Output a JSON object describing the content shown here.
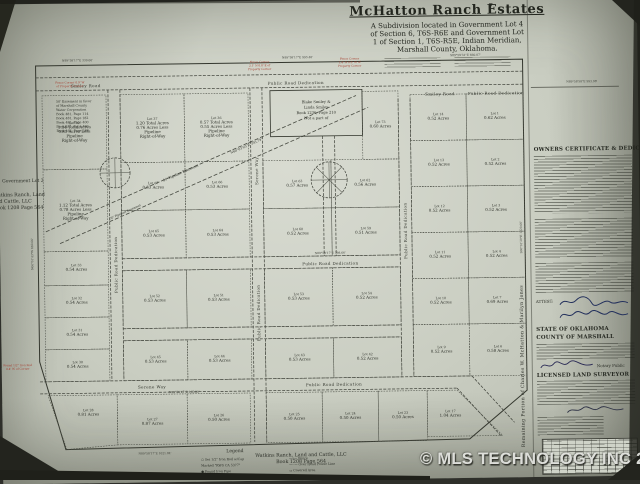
{
  "watermark": "© MLS TECHNOLOGY INC 2026",
  "title_block": {
    "title": "McHatton Ranch Estates",
    "subtitle_lines": [
      "A Subdivision located in Government Lot 4",
      "of Section 6, T6S-R6E and Government Lot",
      "1 of Section 1, T6S-R5E, Indian Meridian,",
      "Marshall County, Oklahoma."
    ]
  },
  "right_panel": {
    "vertical_note": "Remaining Portion of Charles W. McHatton & Marilyn Jones",
    "owners_heading": "OWNERS CERTIFICATE & DEDICATION",
    "attest": "ATTEST:",
    "state": "STATE OF OKLAHOMA",
    "county": "COUNTY OF MARSHALL",
    "notary": "Notary Public",
    "surveyor_heading": "LICENSED LAND SURVEYOR"
  },
  "map": {
    "exception": {
      "x": 272,
      "y": 90,
      "w": 92,
      "h": 46,
      "lines": [
        "Blake Smiley &",
        "Linda Smiley",
        "Book 1236, Page 210",
        "Not a part of"
      ]
    },
    "lots": [
      {
        "x": 44,
        "y": 92,
        "w": 64,
        "h": 74,
        "lines": [
          "Lot 35",
          "1.14 Total Acres",
          "0.81 Acres Less",
          "Pipeline",
          "Right-of-Way"
        ]
      },
      {
        "x": 44,
        "y": 166,
        "w": 64,
        "h": 82,
        "lines": [
          "Lot 34",
          "1.12 Total Acres",
          "0.78 Acres Less",
          "Pipeline",
          "Right-of-Way"
        ]
      },
      {
        "x": 44,
        "y": 248,
        "w": 64,
        "h": 34,
        "lines": [
          "Lot 33",
          "0.54 Acres"
        ]
      },
      {
        "x": 44,
        "y": 282,
        "w": 64,
        "h": 32,
        "lines": [
          "Lot 32",
          "0.54 Acres"
        ]
      },
      {
        "x": 44,
        "y": 314,
        "w": 64,
        "h": 32,
        "lines": [
          "Lot 31",
          "0.54 Acres"
        ]
      },
      {
        "x": 44,
        "y": 346,
        "w": 64,
        "h": 32,
        "lines": [
          "Lot 30",
          "0.54 Acres"
        ]
      },
      {
        "pts": "46,392 115,392 115,442 64,446",
        "cx": 86,
        "cy": 408,
        "lines": [
          "Lot 28",
          "0.81 Acres"
        ]
      },
      {
        "pts": "115,392 185,392 185,442 115,442",
        "cx": 150,
        "cy": 418,
        "lines": [
          "Lot 27",
          "0.87 Acres"
        ]
      },
      {
        "x": 122,
        "y": 92,
        "w": 64,
        "h": 68,
        "lines": [
          "Lot 37",
          "1.20 Total Acres",
          "0.76 Acres Less",
          "Pipeline",
          "Right-of-Way"
        ]
      },
      {
        "x": 186,
        "y": 92,
        "w": 64,
        "h": 68,
        "lines": [
          "Lot 36",
          "0.57 Total Acres",
          "0.55 Acres Less",
          "Pipeline",
          "Right-of-Way"
        ]
      },
      {
        "x": 122,
        "y": 160,
        "w": 64,
        "h": 48,
        "lines": [
          "Lot 67",
          "0.53 Acres"
        ]
      },
      {
        "x": 186,
        "y": 160,
        "w": 64,
        "h": 48,
        "lines": [
          "Lot 66",
          "0.53 Acres"
        ]
      },
      {
        "x": 122,
        "y": 208,
        "w": 64,
        "h": 48,
        "lines": [
          "Lot 65",
          "0.53 Acres"
        ]
      },
      {
        "x": 186,
        "y": 208,
        "w": 64,
        "h": 48,
        "lines": [
          "Lot 64",
          "0.53 Acres"
        ]
      },
      {
        "x": 122,
        "y": 268,
        "w": 64,
        "h": 58,
        "lines": [
          "Lot 52",
          "0.53 Acres"
        ]
      },
      {
        "x": 186,
        "y": 268,
        "w": 64,
        "h": 58,
        "lines": [
          "Lot 51",
          "0.53 Acres"
        ]
      },
      {
        "x": 122,
        "y": 338,
        "w": 64,
        "h": 40,
        "lines": [
          "Lot 45",
          "0.53 Acres"
        ]
      },
      {
        "x": 186,
        "y": 338,
        "w": 64,
        "h": 40,
        "lines": [
          "Lot 44",
          "0.53 Acres"
        ]
      },
      {
        "x": 185,
        "y": 392,
        "w": 63,
        "h": 50,
        "lines": [
          "Lot 26",
          "0.50 Acres"
        ]
      },
      {
        "x": 264,
        "y": 392,
        "w": 56,
        "h": 50,
        "lines": [
          "Lot 25",
          "0.50 Acres"
        ]
      },
      {
        "x": 320,
        "y": 392,
        "w": 56,
        "h": 50,
        "lines": [
          "Lot 24",
          "0.50 Acres"
        ]
      },
      {
        "x": 376,
        "y": 392,
        "w": 49,
        "h": 50,
        "lines": [
          "Lot 23",
          "0.50 Acres"
        ]
      },
      {
        "pts": "425,392 455,392 500,438 425,438",
        "cx": 448,
        "cy": 414,
        "lines": [
          "Lot 17",
          "1.04 Acres"
        ]
      },
      {
        "x": 364,
        "y": 92,
        "w": 36,
        "h": 68,
        "lines": [
          "Lot 73",
          "0.60 Acres"
        ]
      },
      {
        "x": 264,
        "y": 160,
        "w": 68,
        "h": 48,
        "lines": [
          "Lot 63",
          "0.57 Acres"
        ]
      },
      {
        "x": 332,
        "y": 160,
        "w": 68,
        "h": 48,
        "lines": [
          "Lot 62",
          "0.56 Acres"
        ]
      },
      {
        "x": 264,
        "y": 208,
        "w": 68,
        "h": 48,
        "lines": [
          "Lot 60",
          "0.52 Acres"
        ]
      },
      {
        "x": 332,
        "y": 208,
        "w": 68,
        "h": 48,
        "lines": [
          "Lot 59",
          "0.51 Acres"
        ]
      },
      {
        "x": 264,
        "y": 268,
        "w": 68,
        "h": 58,
        "lines": [
          "Lot 53",
          "0.53 Acres"
        ]
      },
      {
        "x": 332,
        "y": 268,
        "w": 68,
        "h": 58,
        "lines": [
          "Lot 54",
          "0.52 Acres"
        ]
      },
      {
        "x": 264,
        "y": 338,
        "w": 68,
        "h": 40,
        "lines": [
          "Lot 43",
          "0.53 Acres"
        ]
      },
      {
        "x": 332,
        "y": 338,
        "w": 68,
        "h": 40,
        "lines": [
          "Lot 42",
          "0.52 Acres"
        ]
      },
      {
        "x": 412,
        "y": 96,
        "w": 56,
        "h": 46,
        "lines": [
          "Lot 14",
          "0.52 Acres"
        ]
      },
      {
        "x": 412,
        "y": 142,
        "w": 56,
        "h": 46,
        "lines": [
          "Lot 13",
          "0.52 Acres"
        ]
      },
      {
        "x": 412,
        "y": 188,
        "w": 56,
        "h": 46,
        "lines": [
          "Lot 12",
          "0.52 Acres"
        ]
      },
      {
        "x": 412,
        "y": 234,
        "w": 56,
        "h": 46,
        "lines": [
          "Lot 11",
          "0.52 Acres"
        ]
      },
      {
        "x": 412,
        "y": 280,
        "w": 56,
        "h": 46,
        "lines": [
          "Lot 10",
          "0.52 Acres"
        ]
      },
      {
        "x": 412,
        "y": 326,
        "w": 56,
        "h": 52,
        "lines": [
          "Lot 9",
          "0.52 Acres"
        ]
      },
      {
        "x": 468,
        "y": 96,
        "w": 57,
        "h": 46,
        "lines": [
          "Lot 1",
          "0.62 Acres"
        ]
      },
      {
        "x": 468,
        "y": 142,
        "w": 57,
        "h": 46,
        "lines": [
          "Lot 2",
          "0.52 Acres"
        ]
      },
      {
        "x": 468,
        "y": 188,
        "w": 57,
        "h": 46,
        "lines": [
          "Lot 3",
          "0.52 Acres"
        ]
      },
      {
        "x": 468,
        "y": 234,
        "w": 57,
        "h": 46,
        "lines": [
          "Lot 4",
          "0.52 Acres"
        ]
      },
      {
        "x": 468,
        "y": 280,
        "w": 57,
        "h": 46,
        "lines": [
          "Lot 7",
          "0.69 Acres"
        ]
      },
      {
        "x": 468,
        "y": 326,
        "w": 57,
        "h": 52,
        "lines": [
          "Lot 6",
          "0.58 Acres"
        ]
      }
    ],
    "road_labels": [
      {
        "t": "Smiley Road",
        "x": 88,
        "y": 84
      },
      {
        "t": "Public Road Dedication",
        "x": 298,
        "y": 84
      },
      {
        "t": "Smiley Road",
        "x": 442,
        "y": 97
      },
      {
        "t": "Public Road Dedication",
        "x": 498,
        "y": 97
      },
      {
        "t": "Public Road Dedication",
        "x": 117,
        "y": 262,
        "r": -90
      },
      {
        "t": "Serene Way",
        "x": 259,
        "y": 170,
        "r": -90
      },
      {
        "t": "Public Road Dedication",
        "x": 259,
        "y": 312,
        "r": -90
      },
      {
        "t": "Public Road Dedication",
        "x": 407,
        "y": 232,
        "r": -90
      },
      {
        "t": "Serene Way",
        "x": 150,
        "y": 386
      },
      {
        "t": "Public Road Dedication",
        "x": 332,
        "y": 386
      },
      {
        "t": "Public Road Dedication",
        "x": 330,
        "y": 265
      }
    ],
    "bearings": [
      {
        "t": "N89°58'17\"E  330.00'",
        "x": 80,
        "y": 58
      },
      {
        "t": "N89°58'17\"E  993.40'",
        "x": 300,
        "y": 58
      },
      {
        "t": "S89°59'31\"E  660.07'",
        "x": 468,
        "y": 58
      },
      {
        "t": "N89°58'58\"E  993.98'",
        "x": 584,
        "y": 86
      },
      {
        "t": "N00°01'43\"W  660.00'",
        "x": 33,
        "y": 250,
        "r": -90
      },
      {
        "t": "S00°01'29\"E  1320.00'",
        "x": 522,
        "y": 240,
        "r": -90
      },
      {
        "t": "N89°58'17\"E  1021.84'",
        "x": 152,
        "y": 452
      },
      {
        "t": "N89°58'17\"E  398.66'",
        "x": 330,
        "y": 254
      },
      {
        "t": "N89°58'17\"E  165.00'",
        "x": 182,
        "y": 391
      }
    ],
    "notes": [
      {
        "x": 58,
        "y": 99,
        "align": "start",
        "fs": 3.2,
        "lh": 4.2,
        "lines": [
          "50' Easement in favor",
          "of Marshall County",
          "Water Corporation",
          "Book 481, Page 114",
          "Book 481, Page 182",
          "Book 481, Page 400",
          "Book 481, Page 480",
          "Book 462, Page 288"
        ]
      },
      {
        "x": 3,
        "y": 178,
        "align": "start",
        "fs": 4.5,
        "lines": [
          "Government Lot 2"
        ]
      },
      {
        "x": -6,
        "y": 192,
        "align": "start",
        "fs": 4.8,
        "lh": 6.4,
        "lines": [
          "Watkins Ranch, Land",
          "and Cattle, LLC",
          "Book 1208 Page 564"
        ]
      },
      {
        "x": 298,
        "y": 456,
        "fs": 4.8,
        "lh": 6.5,
        "lines": [
          "Watkins Ranch, Land and Cattle, LLC",
          "Book 1208 Page 564"
        ]
      },
      {
        "x": 182,
        "y": 172,
        "r": -23,
        "fs": 3.4,
        "lines": [
          "50' Pipeline Easement"
        ]
      },
      {
        "x": 248,
        "y": 146,
        "r": -23,
        "fs": 3.2,
        "lines": [
          "N60°03'03\"E  393.79'"
        ]
      },
      {
        "x": 126,
        "y": 210,
        "r": -23,
        "fs": 3.0,
        "lines": [
          "50' Pipeline Easement"
        ]
      },
      {
        "x": 494,
        "y": 9,
        "fs": 5,
        "lines": [
          "▼"
        ]
      }
    ],
    "red_notes": [
      {
        "x": 262,
        "y": 62,
        "lines": [
          "Fence Corner",
          "2.1' N  0.8' E of",
          "Property Corner"
        ]
      },
      {
        "x": 352,
        "y": 60,
        "lines": [
          "Fence Corner",
          "1.4' N  0.6' W of",
          "Property Corner"
        ]
      },
      {
        "x": 72,
        "y": 80,
        "lines": [
          "Fence Corner 0.9' W",
          "of Property Corner"
        ]
      },
      {
        "x": 16,
        "y": 362,
        "lines": [
          "Found 1/2\" Iron Rod",
          "0.4' W of Corner"
        ]
      }
    ],
    "legend": {
      "title": "Legend",
      "items": [
        {
          "s": "○",
          "t": "Set 1/2\" Iron Rod w/Cap"
        },
        {
          "s": "",
          "t": "Marked \"RWS CA 5377\""
        },
        {
          "s": "●",
          "t": "Found Iron Pipe"
        },
        {
          "s": "—x—",
          "t": "Fence"
        },
        {
          "s": "—··—",
          "t": "Over Head Power Line"
        },
        {
          "s": "▭",
          "t": "Covered Area"
        }
      ]
    }
  }
}
